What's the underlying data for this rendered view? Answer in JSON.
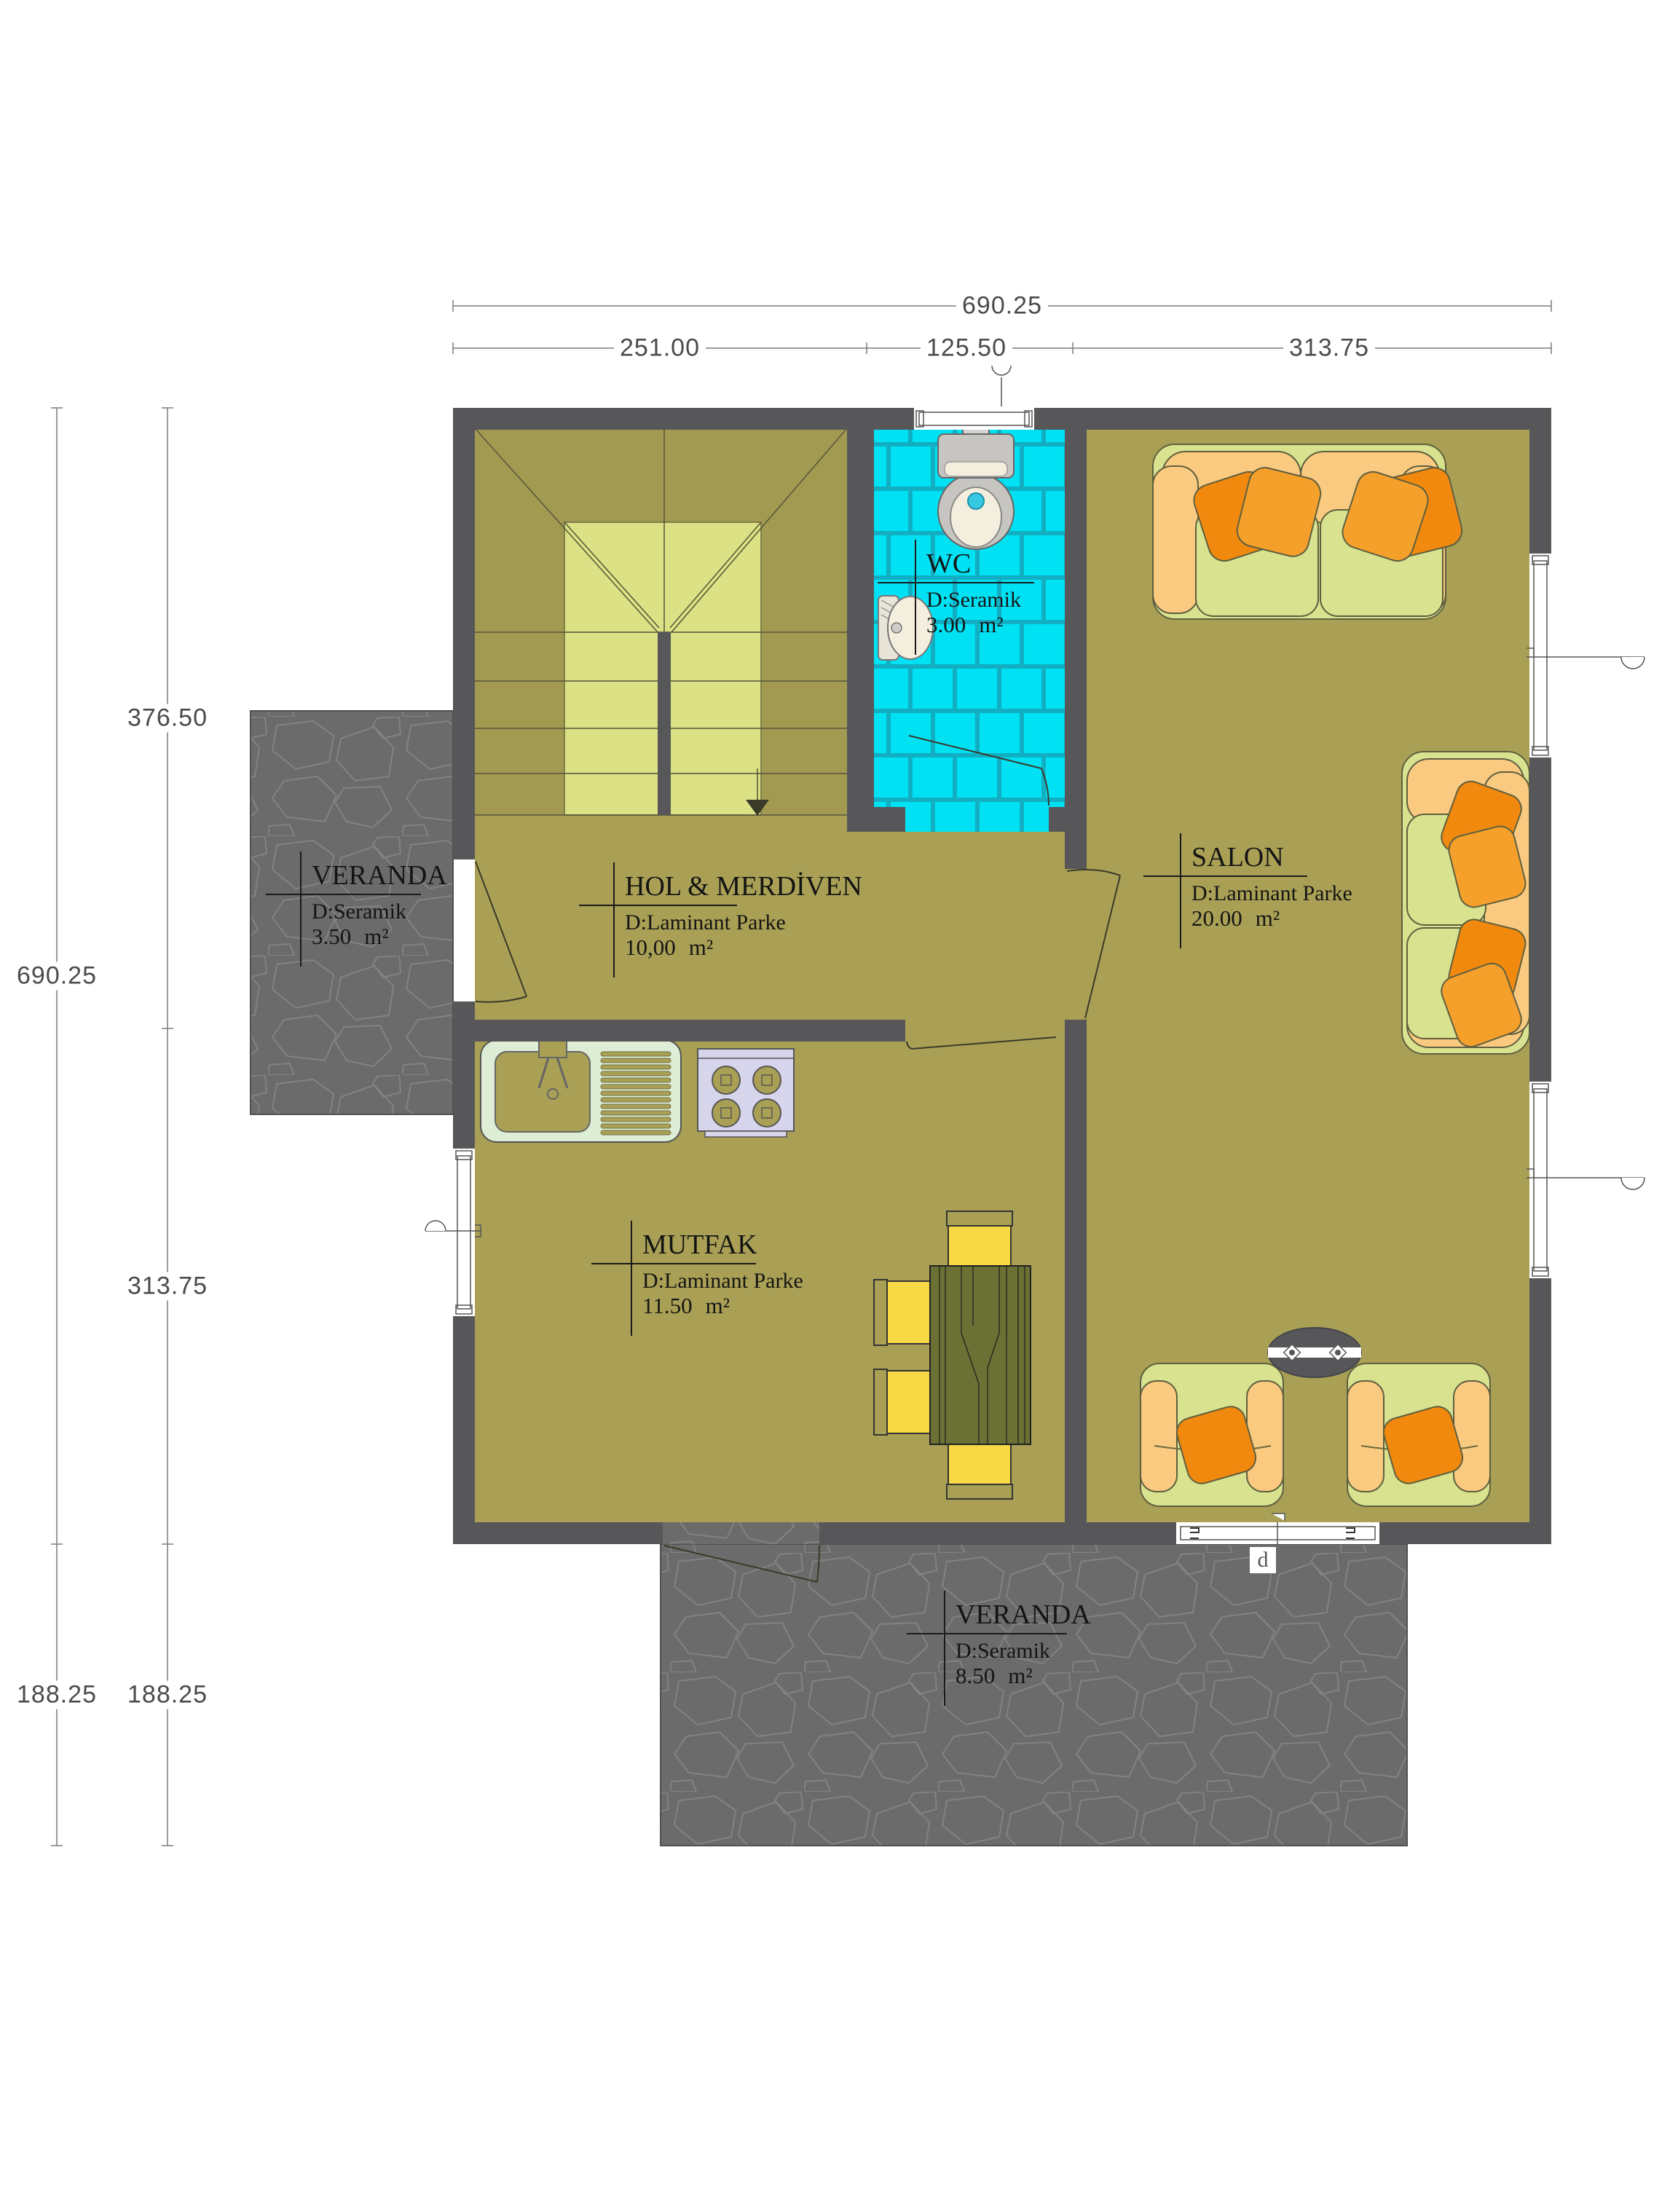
{
  "dimensions": {
    "top_total": "690.25",
    "top_segments": [
      "251.00",
      "125.50",
      "313.75"
    ],
    "left_outer": [
      "690.25",
      "188.25"
    ],
    "left_inner": [
      "376.50",
      "313.75",
      "188.25"
    ]
  },
  "rooms": {
    "wc": {
      "name": "WC",
      "floor": "D:Seramik",
      "area": "3.00",
      "unit": "m²"
    },
    "salon": {
      "name": "SALON",
      "floor": "D:Laminant Parke",
      "area": "20.00",
      "unit": "m²"
    },
    "hol": {
      "name": "HOL & MERDİVEN",
      "floor": "D:Laminant Parke",
      "area": "10,00",
      "unit": "m²"
    },
    "veranda_left": {
      "name": "VERANDA",
      "floor": "D:Seramik",
      "area": "3.50",
      "unit": "m²"
    },
    "mutfak": {
      "name": "MUTFAK",
      "floor": "D:Laminant Parke",
      "area": "11.50",
      "unit": "m²"
    },
    "veranda_bottom": {
      "name": "VERANDA",
      "floor": "D:Seramik",
      "area": "8.50",
      "unit": "m²"
    }
  },
  "tags": {
    "door": "d"
  },
  "colors": {
    "wall": "#57575A",
    "floor_olive": "#A9A055",
    "stair_light": "#DBE184",
    "tile_cyan": "#00E2F4",
    "tile_grout": "#12AEC2",
    "stone": "#6B6B6B",
    "sofa_peach": "#FACA80",
    "sofa_green": "#D9E28F",
    "pillow_orange": "#F0890D",
    "chair_yellow": "#F7D845",
    "table_green": "#6B7034",
    "sink_mint": "#DEEED6",
    "stove_lavender": "#D7D5EB"
  }
}
